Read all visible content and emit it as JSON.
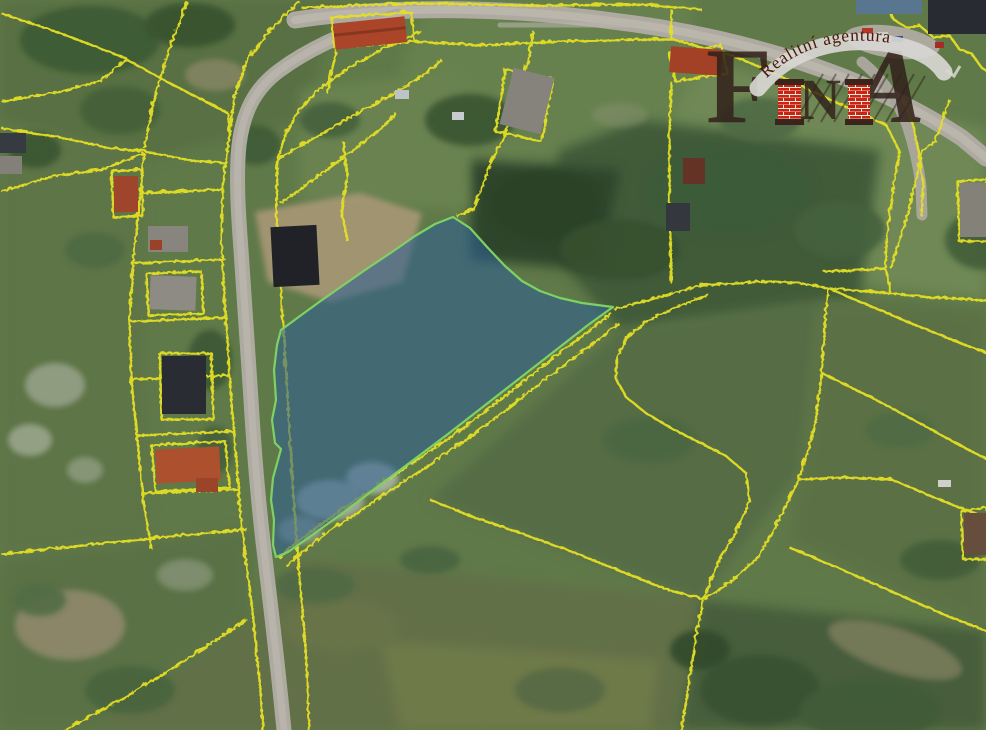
{
  "brand": {
    "letter_f": "F",
    "letter_n": "N",
    "letter_a": "A",
    "tagline": "Realitní agentura",
    "colors": {
      "letters": "#31211a",
      "bricks": "#c82412",
      "mortar": "#efe7de",
      "band": "#d8d7d2",
      "tagline_text": "#4a170c"
    }
  },
  "map": {
    "kind": "aerial-photo-with-cadastral-overlay",
    "colors": {
      "highlighted_parcel_fill": "#30669b",
      "highlighted_parcel_outline": "#86df69",
      "cadastral_boundary": "#f2ec28",
      "road": "#b8b4aa",
      "grass": "#66804d"
    }
  }
}
